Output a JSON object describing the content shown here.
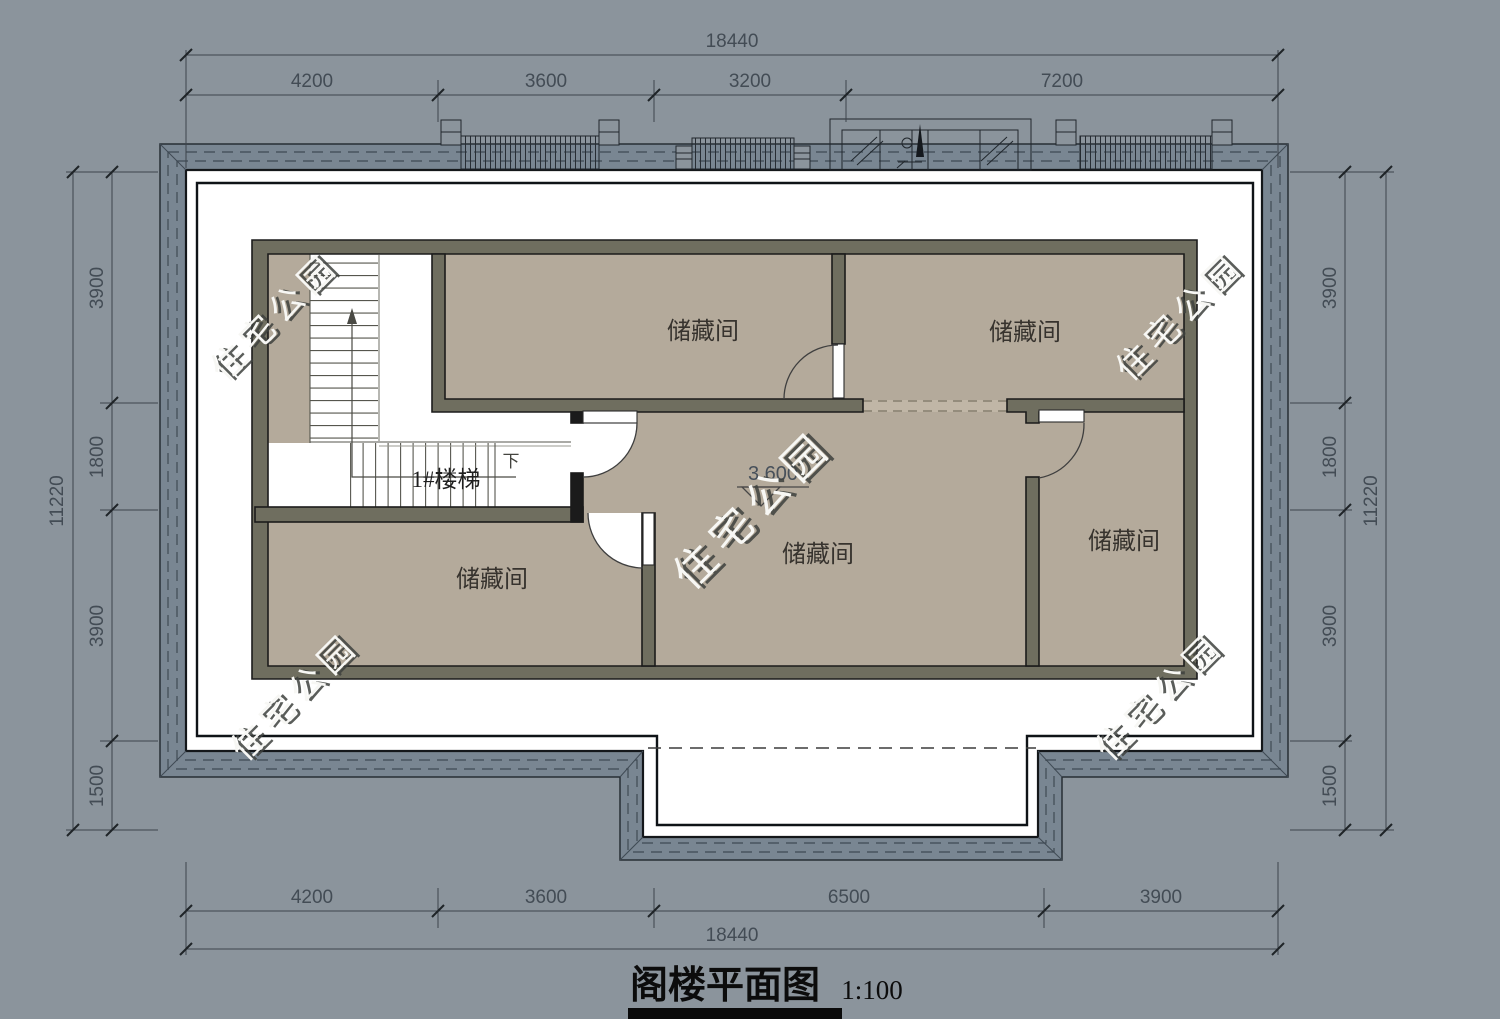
{
  "drawing": {
    "title": "阁楼平面图",
    "scale": "1:100"
  },
  "labels": {
    "storage": "储藏间",
    "stair": "1#楼梯",
    "down": "下",
    "elevation": "3.600"
  },
  "watermark": {
    "text": "住宅公园"
  },
  "dimensions": {
    "top": {
      "overall": "18440",
      "segments": [
        "4200",
        "3600",
        "3200",
        "7200"
      ]
    },
    "bottom": {
      "overall": "18440",
      "segments": [
        "4200",
        "3600",
        "6500",
        "3900"
      ]
    },
    "left": {
      "overall": "11220",
      "segments": [
        "3900",
        "1800",
        "3900",
        "1500"
      ]
    },
    "right": {
      "overall": "11220",
      "segments": [
        "3900",
        "1800",
        "3900",
        "1500"
      ]
    }
  },
  "colors": {
    "background": "#8b949c",
    "eave_band": "#798692",
    "wall": "#6f6e5f",
    "floor": "#b4aa9b",
    "paper": "#ffffff"
  }
}
